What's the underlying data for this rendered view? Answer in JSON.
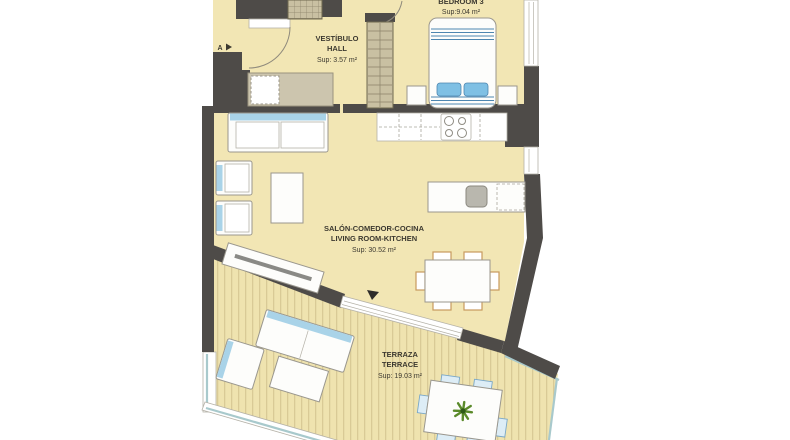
{
  "plan": {
    "marker_a": "A",
    "rooms": {
      "hall": {
        "line1": "VESTÍBULO",
        "line2": "HALL",
        "area": "Sup: 3.57 m²"
      },
      "bedroom3": {
        "line1": "BEDROOM 3",
        "area": "Sup:9.04 m²"
      },
      "living": {
        "line1": "SALÓN-COMEDOR-COCINA",
        "line2": "LIVING ROOM-KITCHEN",
        "area": "Sup: 30.52 m²"
      },
      "terrace": {
        "line1": "TERRAZA",
        "line2": "TERRACE",
        "area": "Sup: 19.03 m²"
      }
    }
  },
  "colors": {
    "wall": "#4e4b48",
    "floor": "#f2e6b4",
    "deck": "#efe3af",
    "deck_stripe": "#d9ca96",
    "accent_blue": "#a9d3e8",
    "accent_blue_dark": "#4d86b0",
    "pillow_blue": "#7fc0e4",
    "railing_teal": "#a8c9cc",
    "wardrobe_tan": "#c9c0a2",
    "chair_tan": "#c89a5e",
    "plant_green": "#5a8a2a",
    "line": "#9a978e",
    "text": "#3c3930"
  }
}
